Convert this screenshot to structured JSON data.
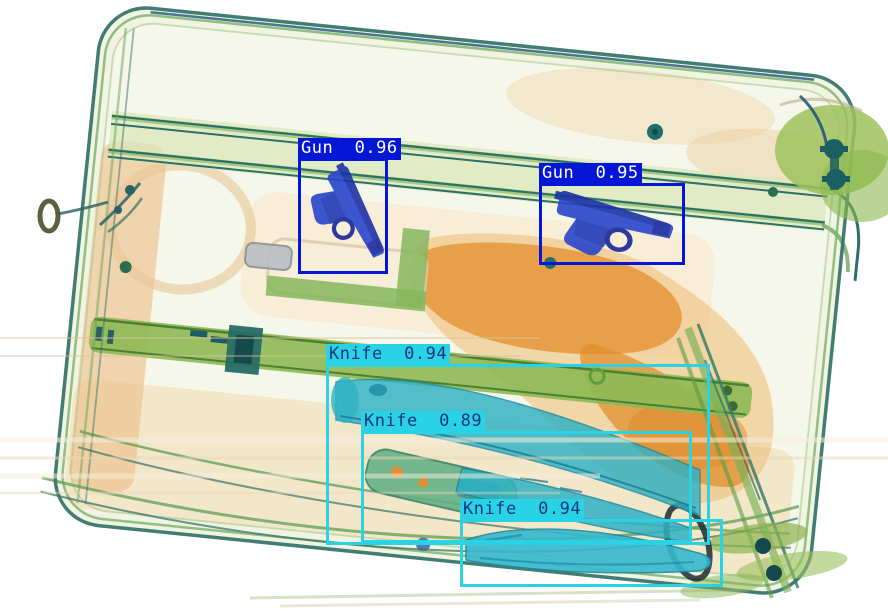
{
  "scene": {
    "kind": "x-ray-baggage-scan",
    "objects": [
      "suitcase",
      "pistol",
      "pistol",
      "knife",
      "knife",
      "knife"
    ]
  },
  "palette": {
    "gun_box": "#0517d6",
    "gun_label_bg": "#0517d6",
    "gun_label_text": "#ffffff",
    "knife_box": "#29d3e5",
    "knife_label_bg": "#29d3e5",
    "knife_label_text": "#15357d",
    "scan_metal_blue": "#2744c6",
    "scan_organic_orange": "#e59a3f",
    "scan_strap_green": "#8fba55",
    "scan_knife_teal": "#2fb2c4"
  },
  "detections": [
    {
      "class": "Gun",
      "score": "0.96",
      "text": "Gun  0.96",
      "box": {
        "x": 299,
        "y": 159,
        "w": 87,
        "h": 113
      },
      "box_color": "#0517d6",
      "label_bg": "#0517d6",
      "label_fg": "#ffffff"
    },
    {
      "class": "Gun",
      "score": "0.95",
      "text": "Gun  0.95",
      "box": {
        "x": 540,
        "y": 184,
        "w": 143,
        "h": 79
      },
      "box_color": "#0517d6",
      "label_bg": "#0517d6",
      "label_fg": "#ffffff"
    },
    {
      "class": "Knife",
      "score": "0.94",
      "text": "Knife  0.94",
      "box": {
        "x": 327,
        "y": 365,
        "w": 381,
        "h": 178
      },
      "box_color": "#29d3e5",
      "label_bg": "#29d3e5",
      "label_fg": "#15357d"
    },
    {
      "class": "Knife",
      "score": "0.89",
      "text": "Knife  0.89",
      "box": {
        "x": 362,
        "y": 432,
        "w": 328,
        "h": 109
      },
      "box_color": "#29d3e5",
      "label_bg": "#29d3e5",
      "label_fg": "#15357d"
    },
    {
      "class": "Knife",
      "score": "0.94",
      "text": "Knife  0.94",
      "box": {
        "x": 461,
        "y": 520,
        "w": 260,
        "h": 65
      },
      "box_color": "#29d3e5",
      "label_bg": "#29d3e5",
      "label_fg": "#15357d"
    }
  ]
}
